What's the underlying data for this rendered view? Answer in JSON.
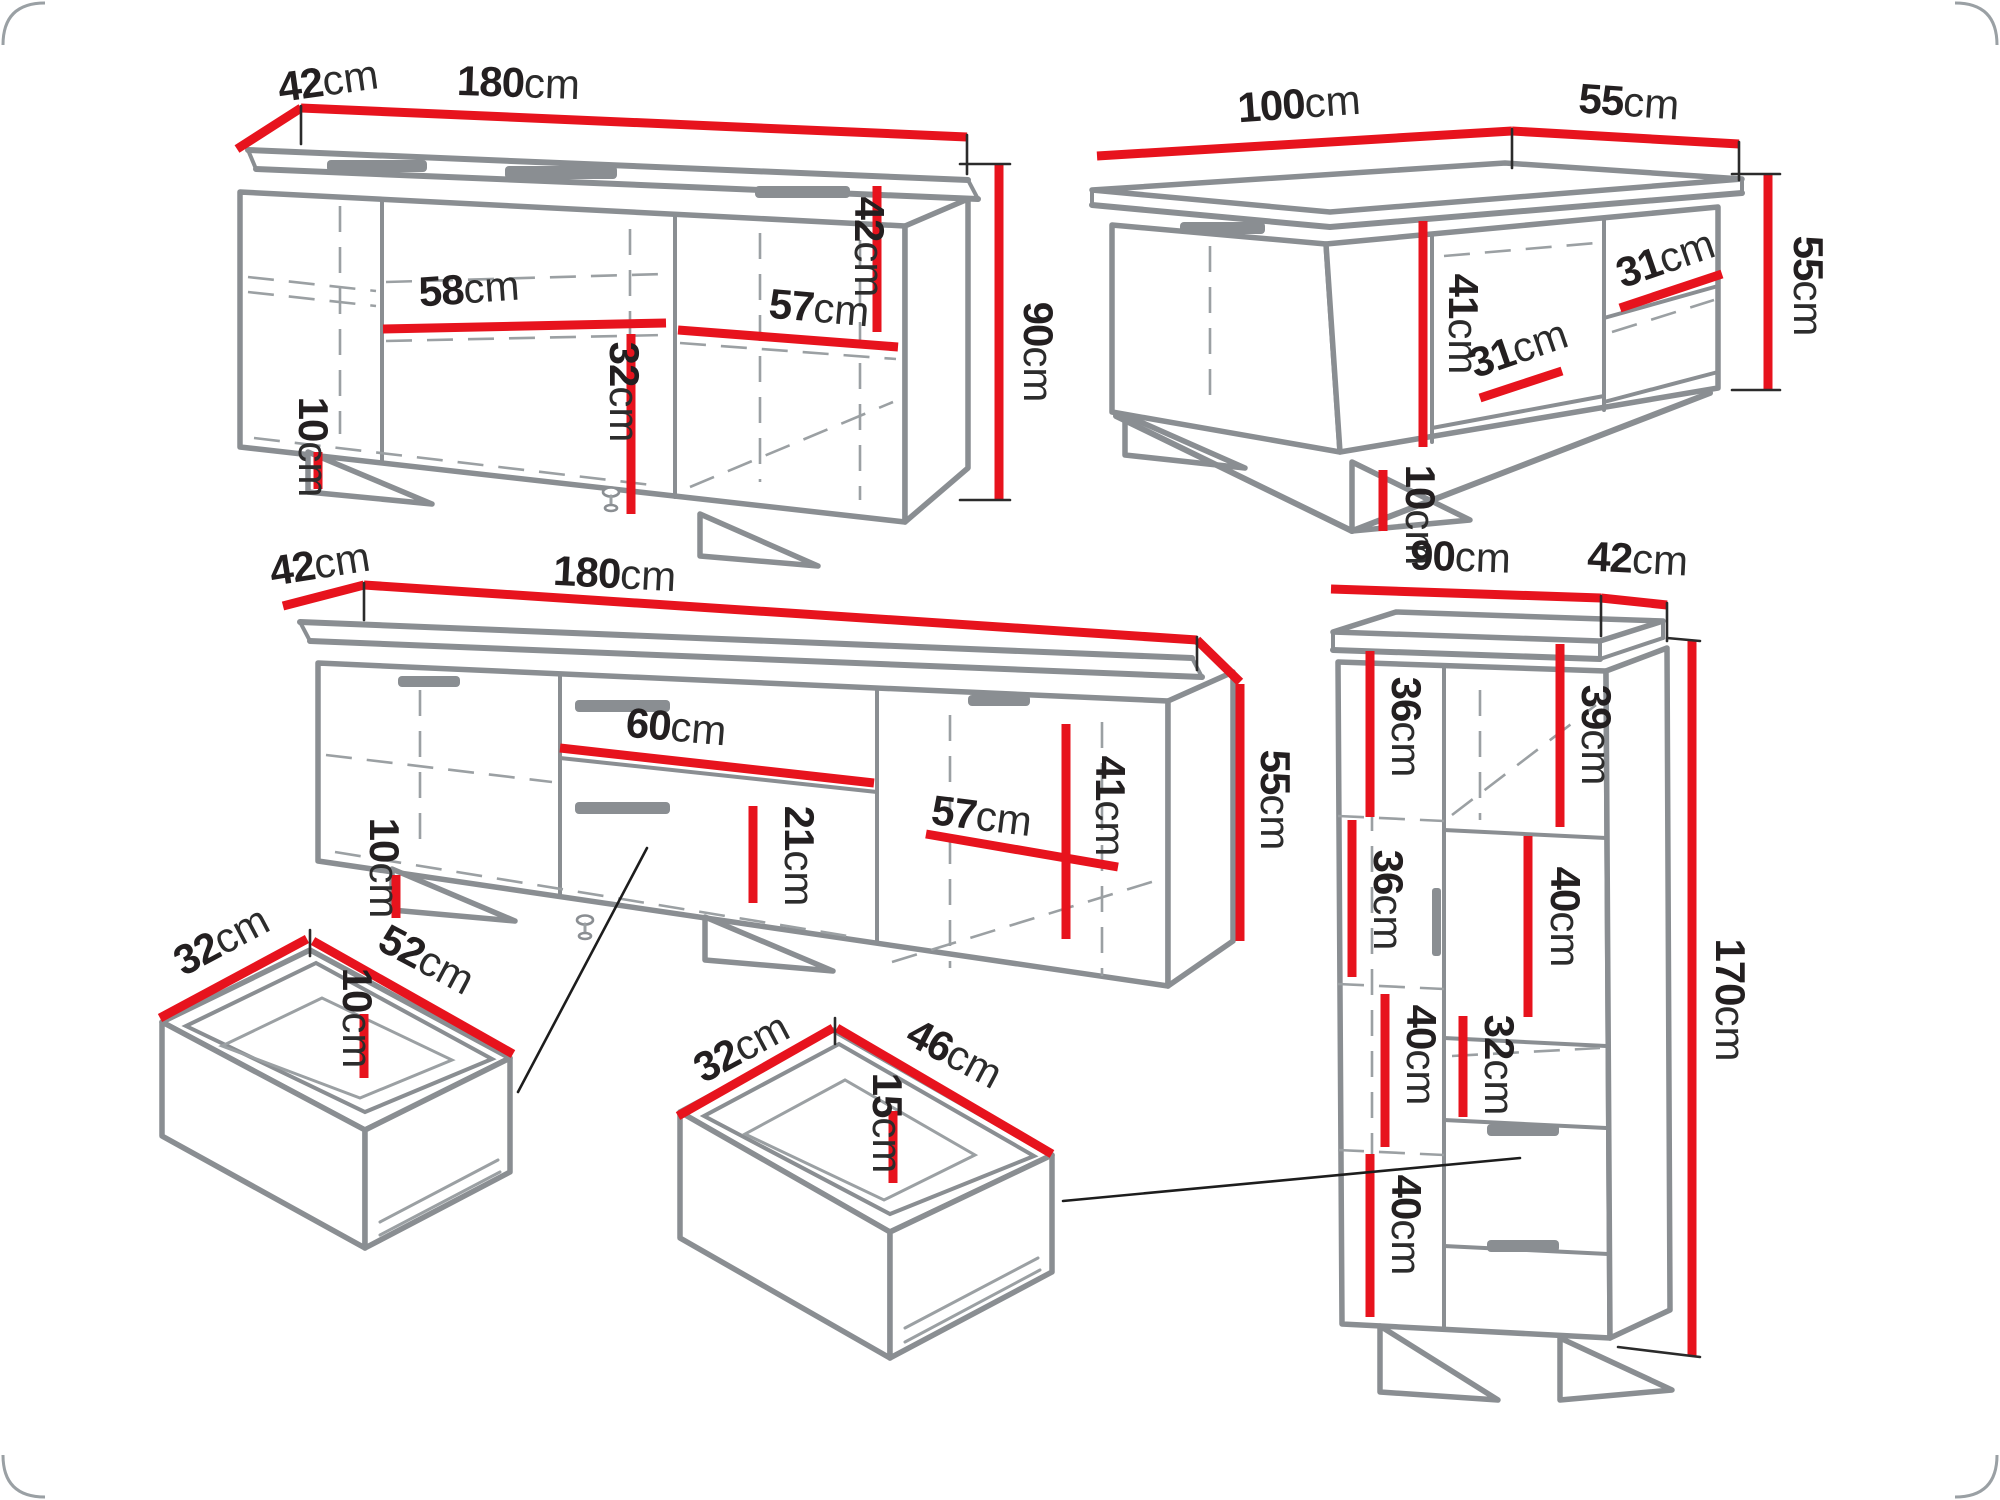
{
  "diagram": {
    "type": "furniture-dimension-diagram",
    "unit": "cm",
    "accent_color": "#e7131d",
    "outline_color": "#8a8e92",
    "pieces": {
      "sideboard": {
        "depth": {
          "v": "42",
          "u": "cm"
        },
        "width": {
          "v": "180",
          "u": "cm"
        },
        "height": {
          "v": "90",
          "u": "cm"
        },
        "shelf_width_left": {
          "v": "58",
          "u": "cm"
        },
        "shelf_width_right": {
          "v": "57",
          "u": "cm"
        },
        "compartment_height": {
          "v": "42",
          "u": "cm"
        },
        "lower_compartment_height": {
          "v": "32",
          "u": "cm"
        },
        "leg_height": {
          "v": "10",
          "u": "cm"
        }
      },
      "coffee_table": {
        "width": {
          "v": "100",
          "u": "cm"
        },
        "depth": {
          "v": "55",
          "u": "cm"
        },
        "height": {
          "v": "55",
          "u": "cm"
        },
        "inner_height": {
          "v": "41",
          "u": "cm"
        },
        "shelf_width_middle": {
          "v": "31",
          "u": "cm"
        },
        "shelf_width_right": {
          "v": "31",
          "u": "cm"
        },
        "leg_height": {
          "v": "10",
          "u": "cm"
        }
      },
      "tv_stand": {
        "depth": {
          "v": "42",
          "u": "cm"
        },
        "width": {
          "v": "180",
          "u": "cm"
        },
        "height": {
          "v": "55",
          "u": "cm"
        },
        "drawer_width": {
          "v": "60",
          "u": "cm"
        },
        "drawer_front_height": {
          "v": "21",
          "u": "cm"
        },
        "door_width": {
          "v": "57",
          "u": "cm"
        },
        "inner_height": {
          "v": "41",
          "u": "cm"
        },
        "leg_height": {
          "v": "10",
          "u": "cm"
        }
      },
      "tall_cabinet": {
        "width": {
          "v": "90",
          "u": "cm"
        },
        "depth": {
          "v": "42",
          "u": "cm"
        },
        "height": {
          "v": "170",
          "u": "cm"
        },
        "compartment_1": {
          "v": "36",
          "u": "cm"
        },
        "compartment_2": {
          "v": "39",
          "u": "cm"
        },
        "compartment_3": {
          "v": "36",
          "u": "cm"
        },
        "compartment_4": {
          "v": "40",
          "u": "cm"
        },
        "compartment_5": {
          "v": "40",
          "u": "cm"
        },
        "compartment_6": {
          "v": "32",
          "u": "cm"
        },
        "compartment_7": {
          "v": "40",
          "u": "cm"
        }
      },
      "drawer_small": {
        "depth": {
          "v": "32",
          "u": "cm"
        },
        "width": {
          "v": "52",
          "u": "cm"
        },
        "inner_height": {
          "v": "10",
          "u": "cm"
        }
      },
      "drawer_large": {
        "depth": {
          "v": "32",
          "u": "cm"
        },
        "width": {
          "v": "46",
          "u": "cm"
        },
        "inner_height": {
          "v": "15",
          "u": "cm"
        }
      }
    }
  }
}
